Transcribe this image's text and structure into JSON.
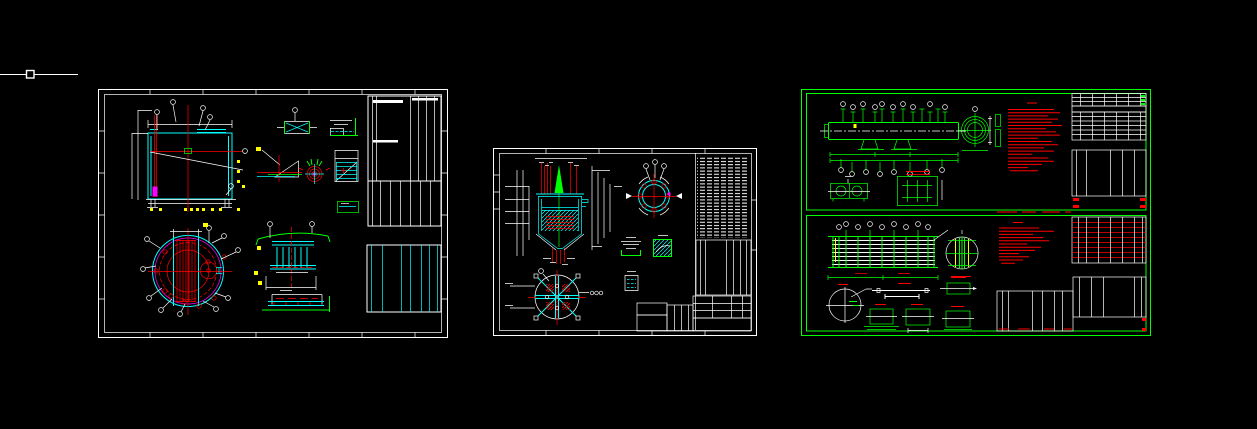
{
  "canvas": {
    "background": "#000000",
    "width": 1257,
    "height": 429
  },
  "cursor": {
    "name": "crosshair-pickbox-cursor",
    "color": "#ffffff"
  },
  "palette": {
    "frame_white": "#ffffff",
    "frame_green": "#00ff00",
    "linework_cyan": "#00ffff",
    "linework_red": "#ff0000",
    "linework_green": "#00ff00",
    "linework_yellow": "#ffff00",
    "linework_magenta": "#ff00ff",
    "notes_red": "#ff0000",
    "table_green": "#00ff00",
    "background": "#000000"
  },
  "sheets": [
    {
      "id": "sheet-1",
      "label": "left drawing sheet - vessel assembly with tube bundle, white frame",
      "frame_color": "#ffffff"
    },
    {
      "id": "sheet-2",
      "label": "middle drawing sheet - agitated vessel, white frame",
      "frame_color": "#ffffff"
    },
    {
      "id": "sheet-3",
      "label": "right drawing sheet - two stacked heat-exchanger drawings, green frame",
      "frame_color": "#00ff00"
    }
  ]
}
